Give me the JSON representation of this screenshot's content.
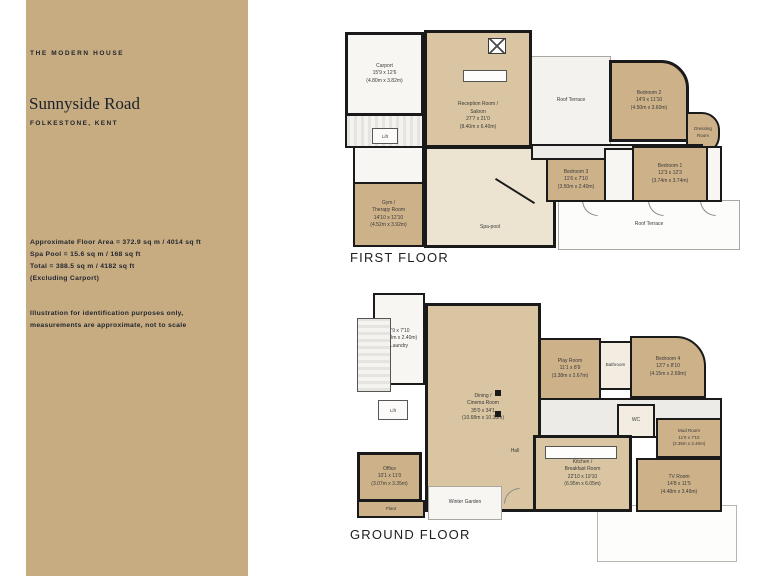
{
  "colors": {
    "sidebar_bg": "#c7ac82",
    "wall": "#1a1a1a",
    "room_dark_tan": "#cdb189",
    "room_mid_tan": "#d9c5a1",
    "room_light_cream": "#ece4d1",
    "text_dark": "#1f232b"
  },
  "sidebar": {
    "brand": "THE MODERN HOUSE",
    "title": "Sunnyside Road",
    "location": "FOLKESTONE, KENT",
    "area_lines": [
      "Approximate Floor Area = 372.9 sq m / 4014 sq ft",
      "Spa Pool = 15.6 sq m / 168 sq ft",
      "Total = 388.5 sq m / 4182 sq ft",
      "(Excluding Carport)"
    ],
    "disclaimer_lines": [
      "Illustration for identification purposes only,",
      "measurements are approximate, not to scale"
    ]
  },
  "first_floor": {
    "caption": "FIRST FLOOR",
    "rooms": {
      "carport": "Carport\n15'9 x 12'6\n(4.80m x 3.82m)",
      "lift": "Lift",
      "gym": "Gym /\nTherapy Room\n14'10 x 12'10\n(4.52m x 3.92m)",
      "reception": "Reception Room /\nSaloon\n27'7 x 21'0\n(8.40m x 6.40m)",
      "spa_pool": "Spa-pool",
      "roof_terrace_top": "Roof Terrace",
      "bedroom2": "Bedroom 2\n14'9 x 11'10\n(4.50m x 3.60m)",
      "dressing": "Dressing\nRoom",
      "bedroom3": "Bedroom 3\n11'6 x 7'10\n(3.50m x 2.40m)",
      "bedroom1": "Bedroom 1\n12'3 x 12'3\n(3.74m x 3.74m)",
      "roof_terrace_bottom": "Roof Terrace"
    }
  },
  "ground_floor": {
    "caption": "GROUND FLOOR",
    "rooms": {
      "laundry": "9'9 x 7'10\n(2.98m x 2.40m)\nLaundry",
      "lift": "Lift",
      "dining": "Dining /\nCinema Room\n35'0 x 34'1\n(10.68m x 10.38m)",
      "hall": "Hall",
      "play_room": "Play Room\n11'1 x 8'9\n(3.38m x 2.67m)",
      "bathroom": "Bathroom",
      "bedroom4": "Bedroom 4\n13'7 x 8'10\n(4.15m x 2.69m)",
      "wc": "WC",
      "mud_room": "Mud Room\n11'0 x 7'10\n(3.35m x 2.40m)",
      "kitchen": "Kitchen /\nBreakfast Room\n22'10 x 19'10\n(6.95m x 6.05m)",
      "tv_room": "TV Room\n14'8 x 11'5\n(4.48m x 3.49m)",
      "office": "Office\n10'1 x 11'0\n(3.07m x 3.35m)",
      "plant": "Plant",
      "winter_garden": "Winter Garden"
    }
  }
}
